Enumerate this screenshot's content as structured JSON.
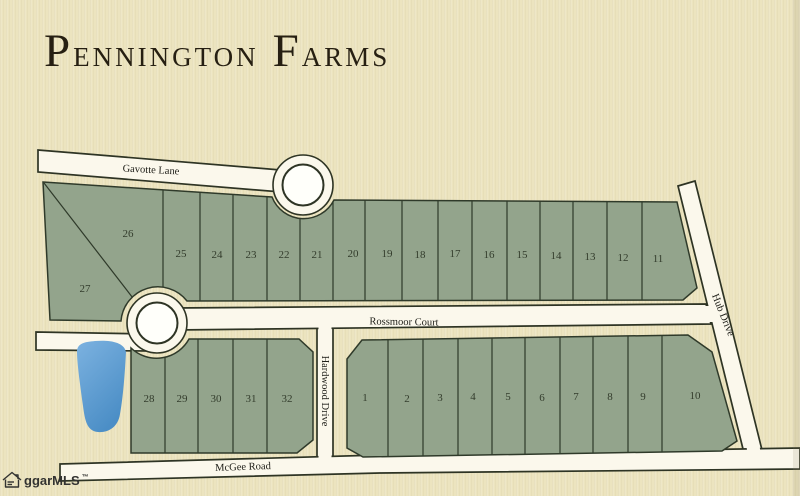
{
  "title": {
    "text": "Pennington Farms",
    "words": [
      {
        "initial": "P",
        "rest": "ENNINGTON"
      },
      {
        "initial": "F",
        "rest": "ARMS"
      }
    ]
  },
  "roads": {
    "gavotte": "Gavotte Lane",
    "rossmoor": "Rossmoor Court",
    "hardwood": "Hardwood Drive",
    "hub": "Hub Drive",
    "mcgee": "McGee Road"
  },
  "lots": {
    "north": [
      "11",
      "12",
      "13",
      "14",
      "15",
      "16",
      "17",
      "18",
      "19",
      "20",
      "21",
      "22",
      "23",
      "24",
      "25",
      "26",
      "27"
    ],
    "southwest": [
      "28",
      "29",
      "30",
      "31",
      "32"
    ],
    "southeast": [
      "1",
      "2",
      "3",
      "4",
      "5",
      "6",
      "7",
      "8",
      "9",
      "10"
    ]
  },
  "watermark": {
    "label": "ggarMLS",
    "trademark": "™"
  },
  "colors": {
    "paper": "#ece4bf",
    "road": "#fbf8ec",
    "road_white": "#fffffa",
    "line": "#2e3424",
    "lot_green": "#93a48c",
    "lot_line": "#2f3a2a",
    "pond_light": "#7cb2e0",
    "pond_dark": "#4b8ec6",
    "text_dark": "#261f12",
    "watermark_gray": "#333331"
  }
}
